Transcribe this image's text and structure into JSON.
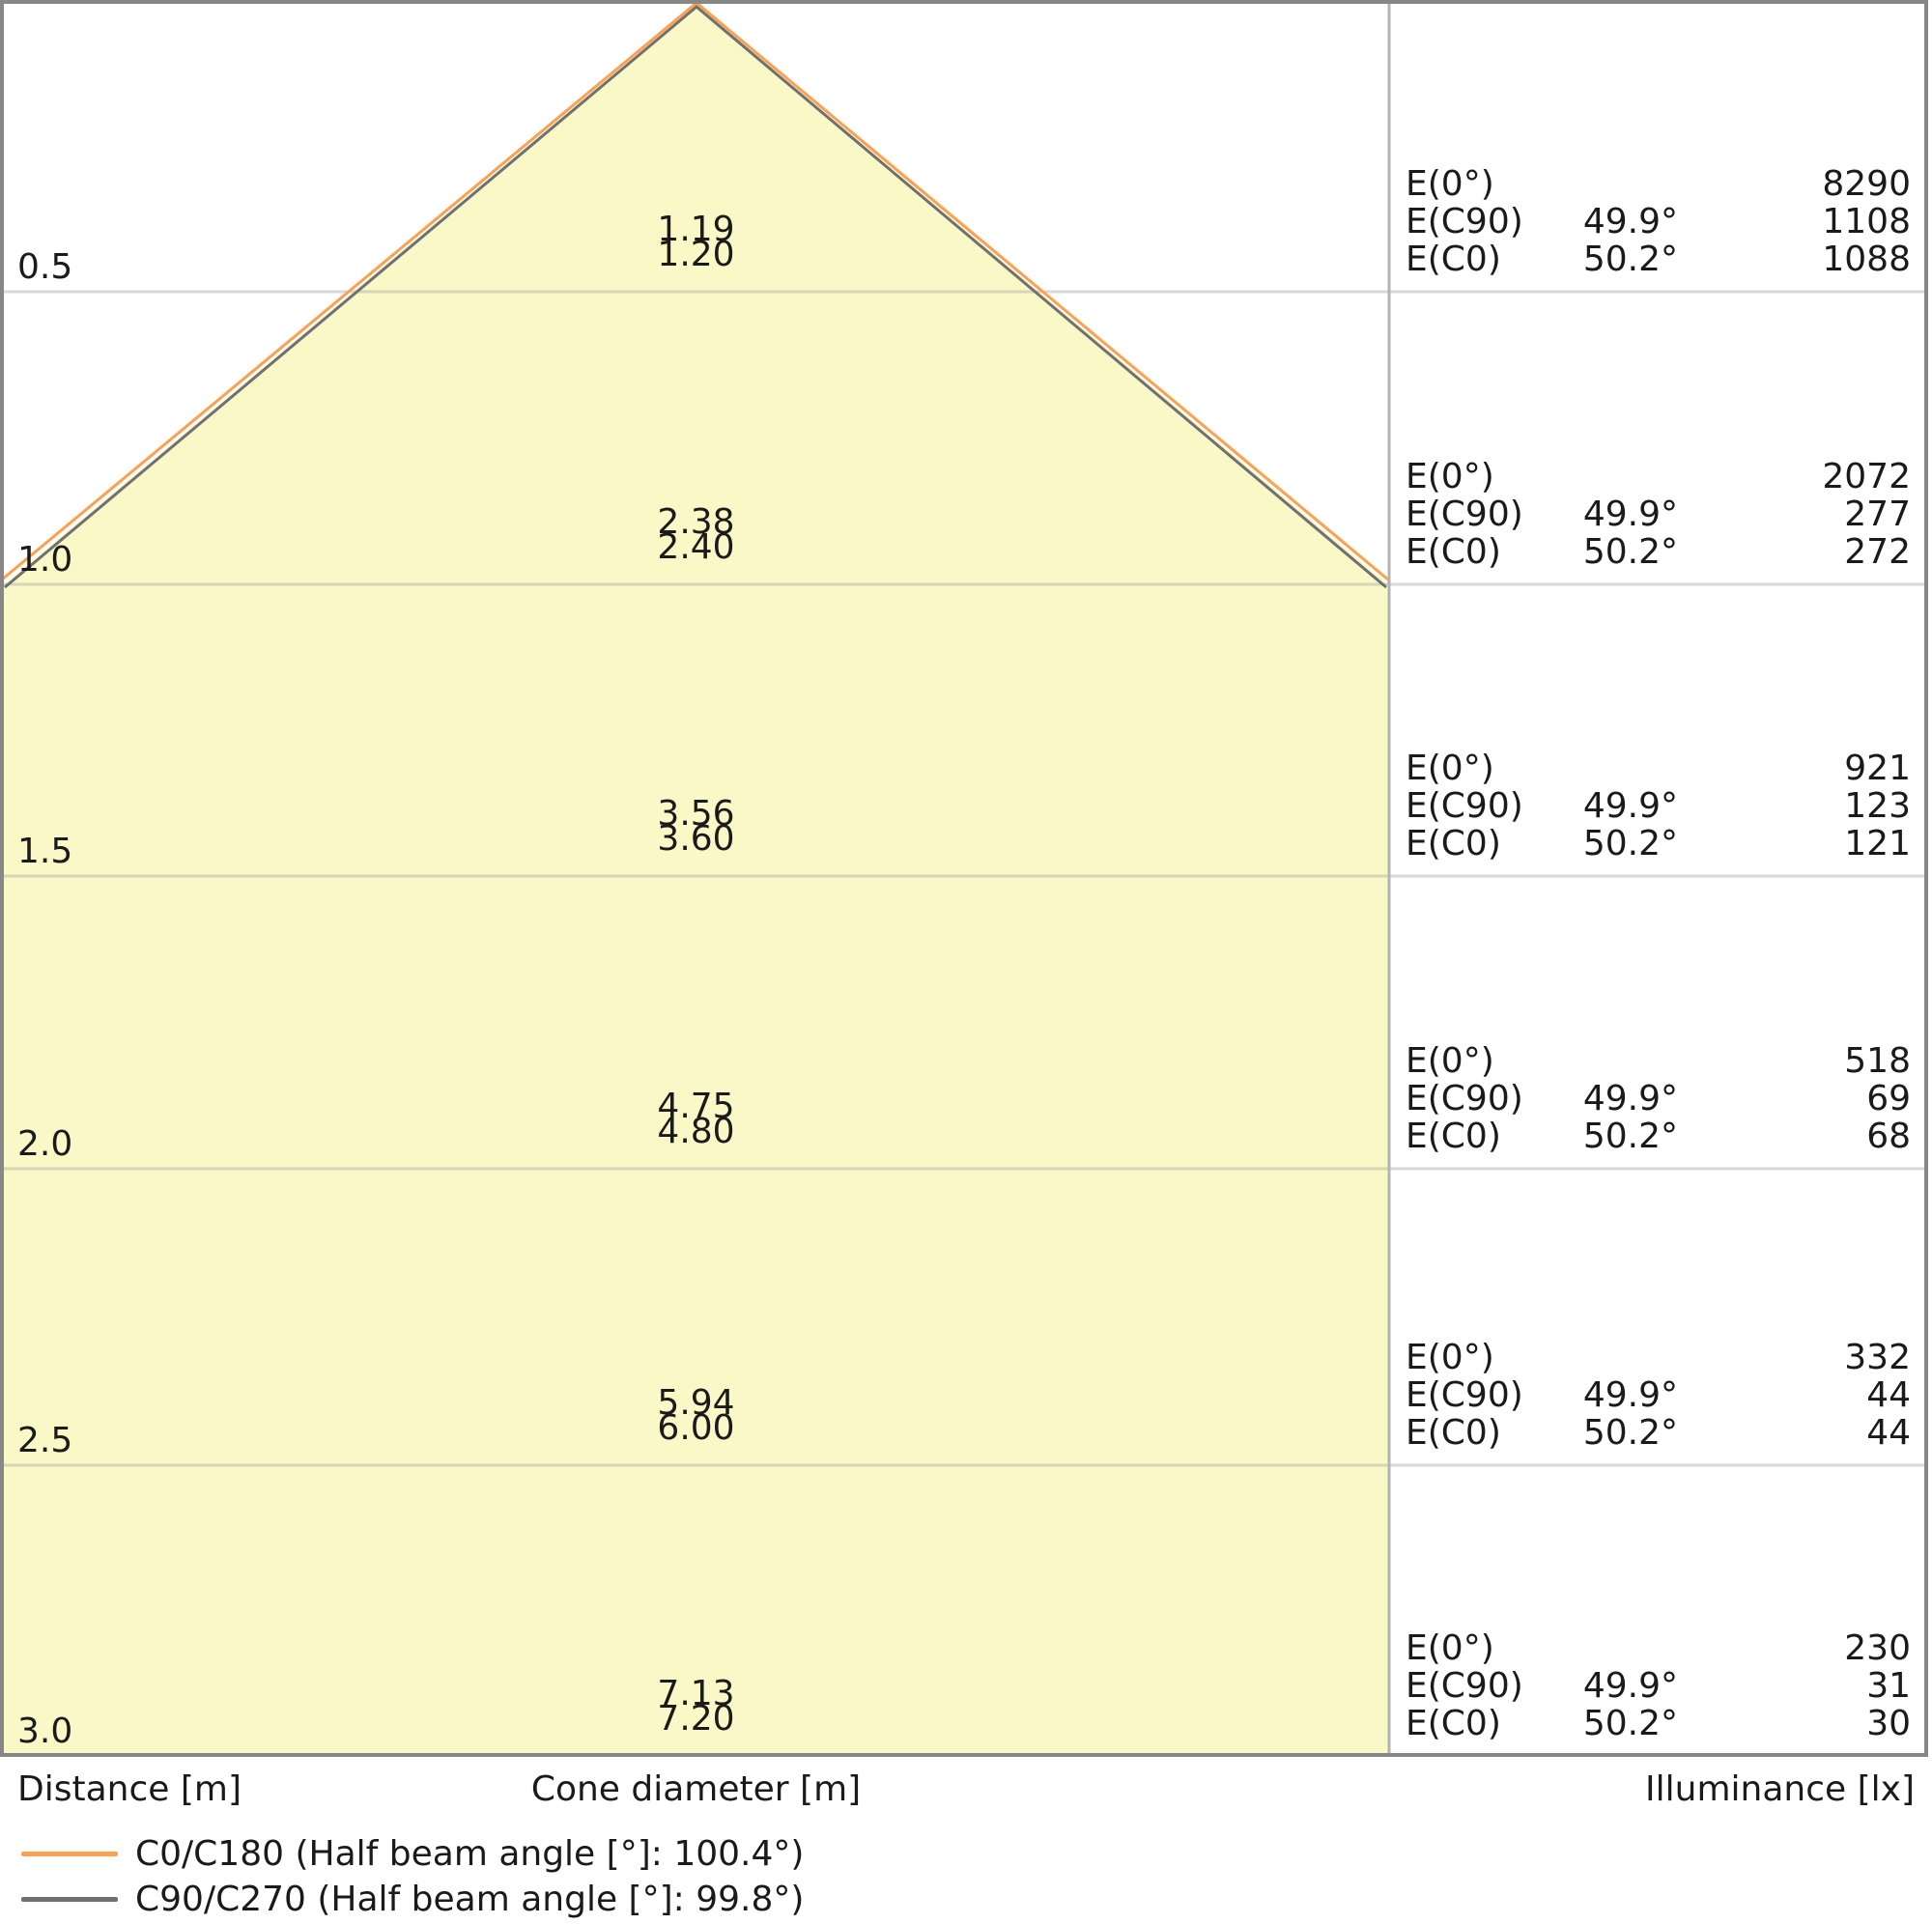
{
  "colors": {
    "cone_fill": "#faf8c6",
    "beam_c0": "#ffa04e",
    "beam_c90": "#707070",
    "grid": "#9a9a9a",
    "divider": "#b3b3b3",
    "border": "#878787",
    "text": "#1a1a1a"
  },
  "footer": {
    "distance_label": "Distance [m]",
    "cone_label": "Cone diameter [m]",
    "illuminance_label": "Illuminance [lx]"
  },
  "legend": {
    "items": [
      {
        "label": "C0/C180 (Half beam angle [°]: 100.4°)",
        "color": "#ffa04e"
      },
      {
        "label": "C90/C270 (Half beam angle [°]: 99.8°)",
        "color": "#707070"
      }
    ]
  },
  "chart_data": {
    "type": "cone-diagram",
    "distances_m": [
      0.5,
      1.0,
      1.5,
      2.0,
      2.5,
      3.0
    ],
    "series": [
      {
        "name": "C0/C180",
        "half_beam_angle_deg": 100.4,
        "cone_diameters_m": [
          1.2,
          2.4,
          3.6,
          4.8,
          6.0,
          7.2
        ]
      },
      {
        "name": "C90/C270",
        "half_beam_angle_deg": 99.8,
        "cone_diameters_m": [
          1.19,
          2.38,
          3.56,
          4.75,
          5.94,
          7.13
        ]
      }
    ],
    "illuminance_lx": {
      "E0": [
        8290,
        2072,
        921,
        518,
        332,
        230
      ],
      "EC90": [
        1108,
        277,
        123,
        69,
        44,
        31
      ],
      "EC0": [
        1088,
        272,
        121,
        68,
        44,
        30
      ]
    },
    "illuminance_labels": {
      "e0": "E(0°)",
      "ec90": "E(C90)",
      "ec0": "E(C0)"
    },
    "axis_labels": {
      "x": "Distance [m]",
      "cone": "Cone diameter [m]",
      "illuminance": "Illuminance [lx]"
    },
    "rows": [
      {
        "distance": "0.5",
        "cone_c90": "1.19",
        "cone_c0": "1.20",
        "e0": "8290",
        "angle_c90": "49.9°",
        "ec90": "1108",
        "angle_c0": "50.2°",
        "ec0": "1088"
      },
      {
        "distance": "1.0",
        "cone_c90": "2.38",
        "cone_c0": "2.40",
        "e0": "2072",
        "angle_c90": "49.9°",
        "ec90": "277",
        "angle_c0": "50.2°",
        "ec0": "272"
      },
      {
        "distance": "1.5",
        "cone_c90": "3.56",
        "cone_c0": "3.60",
        "e0": "921",
        "angle_c90": "49.9°",
        "ec90": "123",
        "angle_c0": "50.2°",
        "ec0": "121"
      },
      {
        "distance": "2.0",
        "cone_c90": "4.75",
        "cone_c0": "4.80",
        "e0": "518",
        "angle_c90": "49.9°",
        "ec90": "69",
        "angle_c0": "50.2°",
        "ec0": "68"
      },
      {
        "distance": "2.5",
        "cone_c90": "5.94",
        "cone_c0": "6.00",
        "e0": "332",
        "angle_c90": "49.9°",
        "ec90": "44",
        "angle_c0": "50.2°",
        "ec0": "44"
      },
      {
        "distance": "3.0",
        "cone_c90": "7.13",
        "cone_c0": "7.20",
        "e0": "230",
        "angle_c90": "49.9°",
        "ec90": "31",
        "angle_c0": "50.2°",
        "ec0": "30"
      }
    ]
  }
}
